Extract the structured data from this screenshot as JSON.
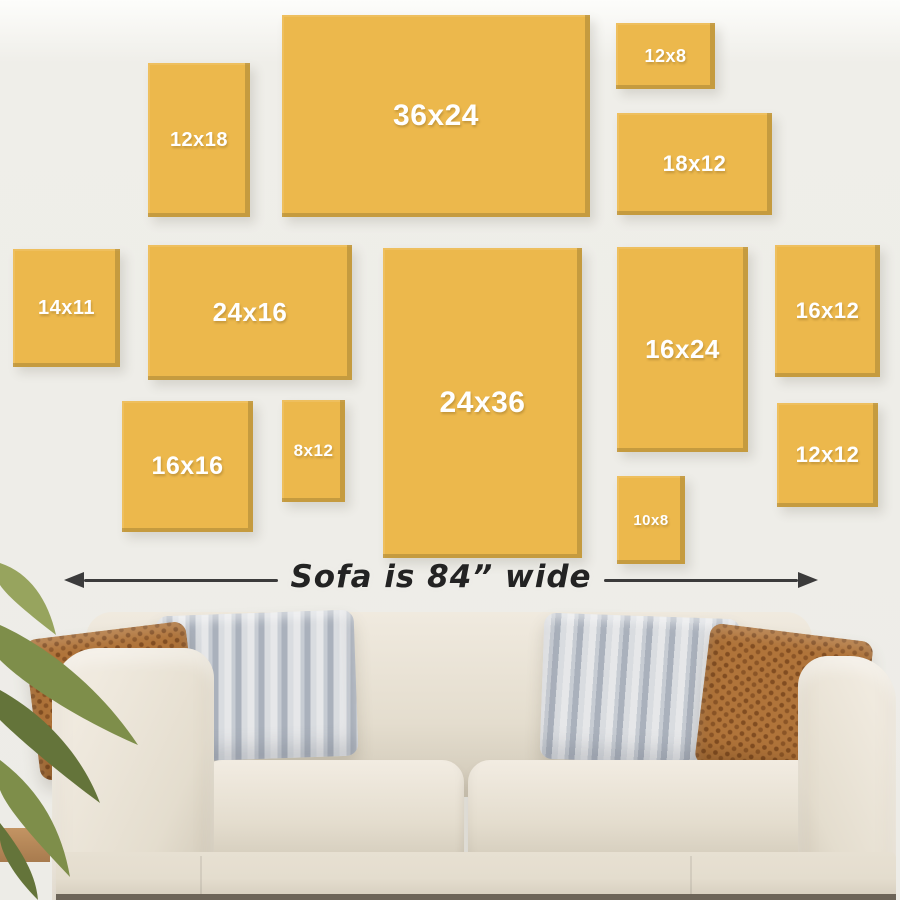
{
  "note": {
    "sofa_width_label": "Sofa is 84” wide"
  },
  "canvases": [
    {
      "label": "12x18",
      "x": 148,
      "y": 63,
      "w": 102,
      "h": 154,
      "label_px": 20
    },
    {
      "label": "36x24",
      "x": 282,
      "y": 15,
      "w": 308,
      "h": 202,
      "label_px": 30
    },
    {
      "label": "12x8",
      "x": 616,
      "y": 23,
      "w": 99,
      "h": 66,
      "label_px": 18
    },
    {
      "label": "18x12",
      "x": 617,
      "y": 113,
      "w": 155,
      "h": 102,
      "label_px": 22
    },
    {
      "label": "14x11",
      "x": 13,
      "y": 249,
      "w": 107,
      "h": 118,
      "label_px": 20
    },
    {
      "label": "24x16",
      "x": 148,
      "y": 245,
      "w": 204,
      "h": 135,
      "label_px": 26
    },
    {
      "label": "24x36",
      "x": 383,
      "y": 248,
      "w": 199,
      "h": 310,
      "label_px": 30
    },
    {
      "label": "16x24",
      "x": 617,
      "y": 247,
      "w": 131,
      "h": 205,
      "label_px": 26
    },
    {
      "label": "16x12",
      "x": 775,
      "y": 245,
      "w": 105,
      "h": 132,
      "label_px": 22
    },
    {
      "label": "16x16",
      "x": 122,
      "y": 401,
      "w": 131,
      "h": 131,
      "label_px": 25
    },
    {
      "label": "8x12",
      "x": 282,
      "y": 400,
      "w": 63,
      "h": 102,
      "label_px": 17
    },
    {
      "label": "10x8",
      "x": 617,
      "y": 476,
      "w": 68,
      "h": 88,
      "label_px": 15
    },
    {
      "label": "12x12",
      "x": 777,
      "y": 403,
      "w": 101,
      "h": 104,
      "label_px": 22
    }
  ],
  "palette": {
    "wall": "#EFEEE9",
    "canvas": "#ECB84C",
    "canvas_label": "#FFFFFF",
    "arrow": "#3B3B3B",
    "note_text": "#232323",
    "fabric_light": "#F0EADF",
    "fabric": "#E4DDCE",
    "fabric_dark": "#CFC7B6",
    "base_line": "#6C6458",
    "pillow_brown": "#B0743A",
    "pillow_gray": "#AAB1BC",
    "pillow_gray_light": "#E6E7E9",
    "plant": "#7E8E4A",
    "plant_light": "#97A45E",
    "plant_dark": "#64743A",
    "wood": "#9B6F45",
    "table_wood": "#C39463"
  }
}
